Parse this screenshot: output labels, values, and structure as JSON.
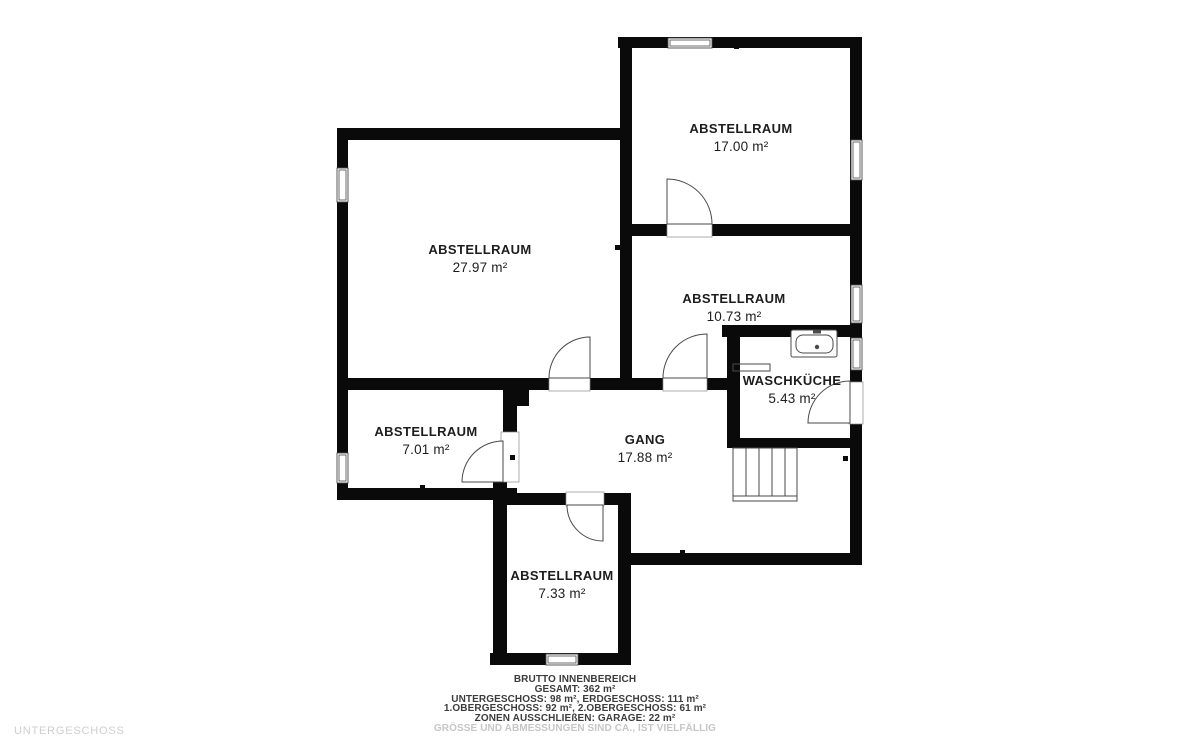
{
  "colors": {
    "wall": "#0a0a0a",
    "door_line": "#4a4a4a",
    "label_text": "#1d1d1d",
    "muted_text": "#c6c6c6",
    "background": "#ffffff"
  },
  "floor_plan": {
    "floor_label": "UNTERGESCHOSS",
    "rooms": [
      {
        "name": "ABSTELLRAUM",
        "area": "17.00 m²"
      },
      {
        "name": "ABSTELLRAUM",
        "area": "27.97 m²"
      },
      {
        "name": "ABSTELLRAUM",
        "area": "10.73 m²"
      },
      {
        "name": "WASCHKÜCHE",
        "area": "5.43 m²"
      },
      {
        "name": "ABSTELLRAUM",
        "area": "7.01 m²"
      },
      {
        "name": "GANG",
        "area": "17.88 m²"
      },
      {
        "name": "ABSTELLRAUM",
        "area": "7.33 m²"
      }
    ],
    "icons": {
      "sink": "sink-icon",
      "stairs": "stairs-icon"
    }
  },
  "footer": {
    "lines": [
      "BRUTTO INNENBEREICH",
      "GESAMT: 362 m²",
      "UNTERGESCHOSS: 98 m², ERDGESCHOSS: 111 m²",
      "1.OBERGESCHOSS: 92 m², 2.OBERGESCHOSS: 61 m²",
      "ZONEN AUSSCHLIEßEN: GARAGE: 22 m²",
      "GRÖSSE UND ABMESSUNGEN SIND CA., IST VIELFÄLLIG"
    ]
  }
}
